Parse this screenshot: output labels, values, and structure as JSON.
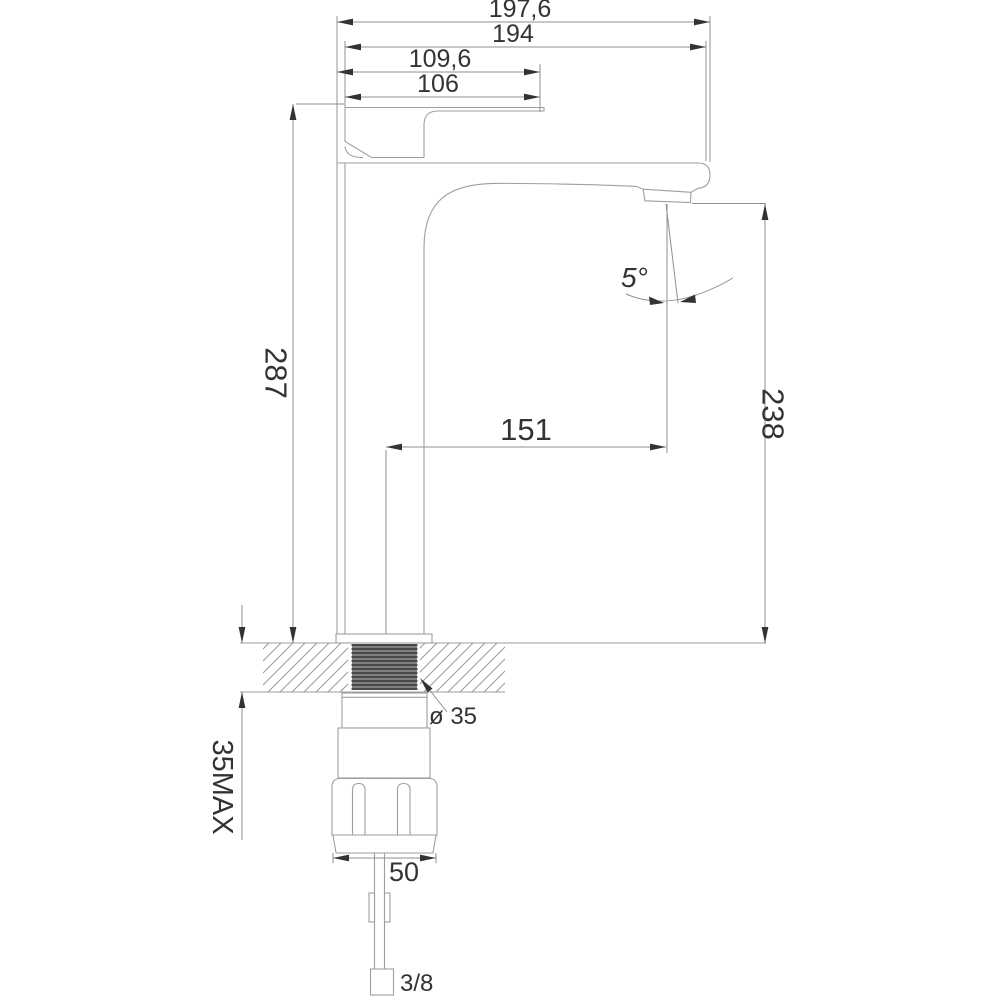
{
  "drawing_title": "faucet-dimension-drawing",
  "dims": {
    "d197": "197,6",
    "d194": "194",
    "d109": "109,6",
    "d106": "106",
    "d287": "287",
    "d151": "151",
    "angle": "5°",
    "d238": "238",
    "dia35": "ø 35",
    "deckmax": "35MAX",
    "d50": "50",
    "thread": "3/8"
  },
  "colors": {
    "background": "#ffffff",
    "outline_gray": "#9e9e9e",
    "dimension_gray": "#8f8f8f",
    "hatch_gray": "#9a9a9a",
    "ink": "#333333",
    "thread_dark": "#3f3f3f"
  }
}
